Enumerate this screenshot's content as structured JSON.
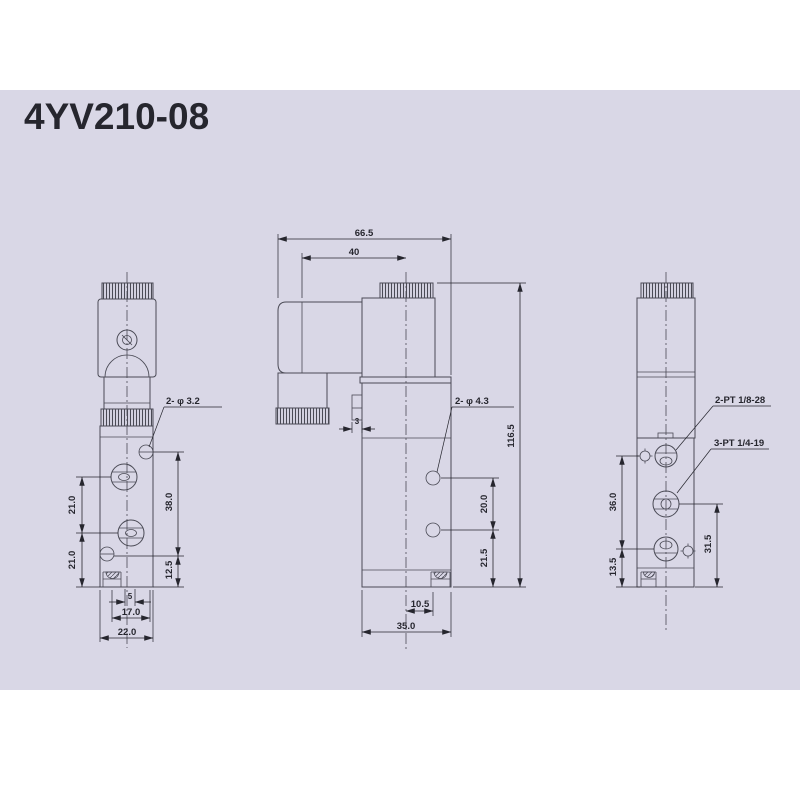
{
  "title": "4YV210-08",
  "colors": {
    "panel": "#d9d7e6",
    "line": "#4a4a55",
    "ink": "#26262e"
  },
  "views": {
    "front": {
      "callout_holes": "2- φ 3.2",
      "dims": {
        "pitch_upper": "21.0",
        "pitch_lower": "21.0",
        "span_38": "38.0",
        "span_125": "12.5",
        "notch_5": "5",
        "width_17": "17.0",
        "width_22": "22.0"
      }
    },
    "side": {
      "callout_holes": "2- φ 4.3",
      "dims": {
        "overall_66": "66.5",
        "coil_40": "40",
        "overall_116": "116.5",
        "pitch_20": "20.0",
        "span_215": "21.5",
        "tab_3": "3",
        "offset_105": "10.5",
        "width_35": "35.0"
      }
    },
    "rear": {
      "callout_port_top": "2-PT 1/8-28",
      "callout_port_mid": "3-PT 1/4-19",
      "dims": {
        "span_36": "36.0",
        "span_135": "13.5",
        "span_315": "31.5"
      }
    }
  }
}
